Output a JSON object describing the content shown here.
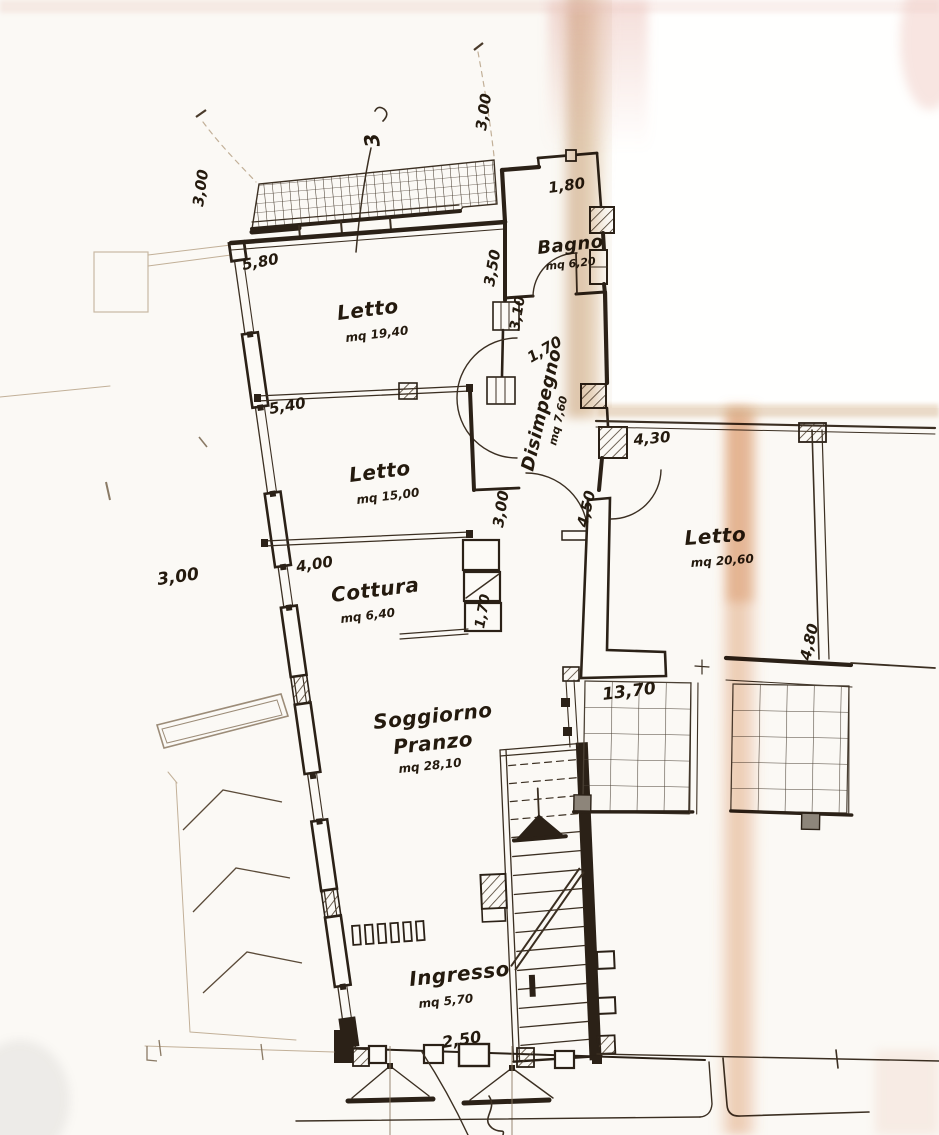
{
  "document": {
    "kind": "scanned floor plan",
    "language": "Italian"
  },
  "rooms": [
    {
      "label": "Letto",
      "area": "mq 19,40"
    },
    {
      "label": "Bagno",
      "area": "mq 6,20"
    },
    {
      "label": "Disimpegno",
      "area": "mq 7,60"
    },
    {
      "label": "Letto",
      "area": "mq 15,00"
    },
    {
      "label": "Cottura",
      "area": "mq 6,40"
    },
    {
      "label": "Soggiorno",
      "label2": "Pranzo",
      "area": "mq 28,10"
    },
    {
      "label": "Ingresso",
      "area": "mq 5,70"
    },
    {
      "label": "Letto",
      "area": "mq 20,60"
    }
  ],
  "dimensions": {
    "top_left": "3,00",
    "top_right": "3,00",
    "balcony_step": "1,80",
    "letto1_top": "5,80",
    "bagno_left": "3,50",
    "bagno_window": "3,10",
    "disimpegno_width": "1,70",
    "letto1_left": "5,40",
    "neighbor_top": "4,30",
    "letto2_right": "3,00",
    "corridor_wall": "4,50",
    "letto2_bottom": "4,00",
    "site_left": "3,00",
    "cottura_right": "1,70",
    "neighbor_right": "4,80",
    "neighbor_balcony": "13,70",
    "entrance_width": "2,50"
  },
  "annotations": {
    "handwritten_mark": "3"
  },
  "colors": {
    "ink": "#2b2117",
    "paper": "#fbf9f5",
    "fold_tan": "#c89a6a",
    "fold_pink": "#dc8c55",
    "tile_gray": "#8d857a"
  }
}
